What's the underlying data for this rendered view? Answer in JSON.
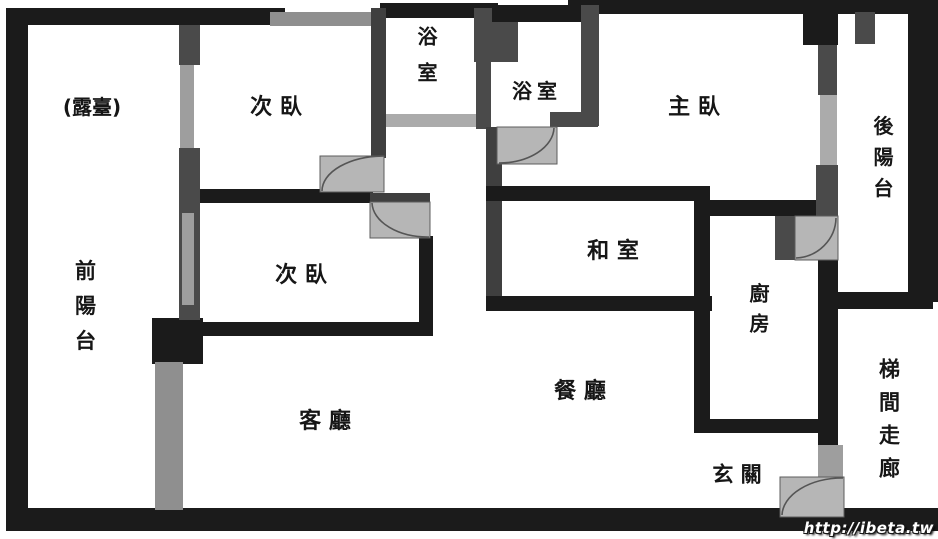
{
  "figure": {
    "kind": "apartment floor plan",
    "language": "zh-TW"
  },
  "rooms": {
    "terrace": {
      "label": "(露臺)",
      "meaning": "terrace"
    },
    "bedroom_top": {
      "label": "次 臥",
      "meaning": "secondary bedroom"
    },
    "bathroom_1": {
      "label": "浴室",
      "meaning": "bathroom"
    },
    "bathroom_2": {
      "label": "浴室",
      "meaning": "bathroom"
    },
    "master_bedroom": {
      "label": "主 臥",
      "meaning": "master bedroom"
    },
    "back_balcony": {
      "label": "後陽台",
      "meaning": "back balcony"
    },
    "front_balcony": {
      "label": "前陽台",
      "meaning": "front balcony"
    },
    "bedroom_middle": {
      "label": "次 臥",
      "meaning": "secondary bedroom"
    },
    "tatami_room": {
      "label": "和 室",
      "meaning": "tatami room"
    },
    "kitchen": {
      "label": "廚房",
      "meaning": "kitchen"
    },
    "dining_room": {
      "label": "餐 廳",
      "meaning": "dining room"
    },
    "living_room": {
      "label": "客 廳",
      "meaning": "living room"
    },
    "entry": {
      "label": "玄 關",
      "meaning": "entryway"
    },
    "stair_corridor": {
      "label": "梯間走廊",
      "meaning": "stair corridor"
    }
  },
  "watermark": {
    "text": "http://ibeta.tw"
  },
  "colors": {
    "wall_main": "#1b1b1b",
    "wall_secondary": "#4a4a4a",
    "window": "#a3a3a3",
    "door": "#b6b6b6",
    "background": "#ffffff",
    "text": "#161616"
  }
}
